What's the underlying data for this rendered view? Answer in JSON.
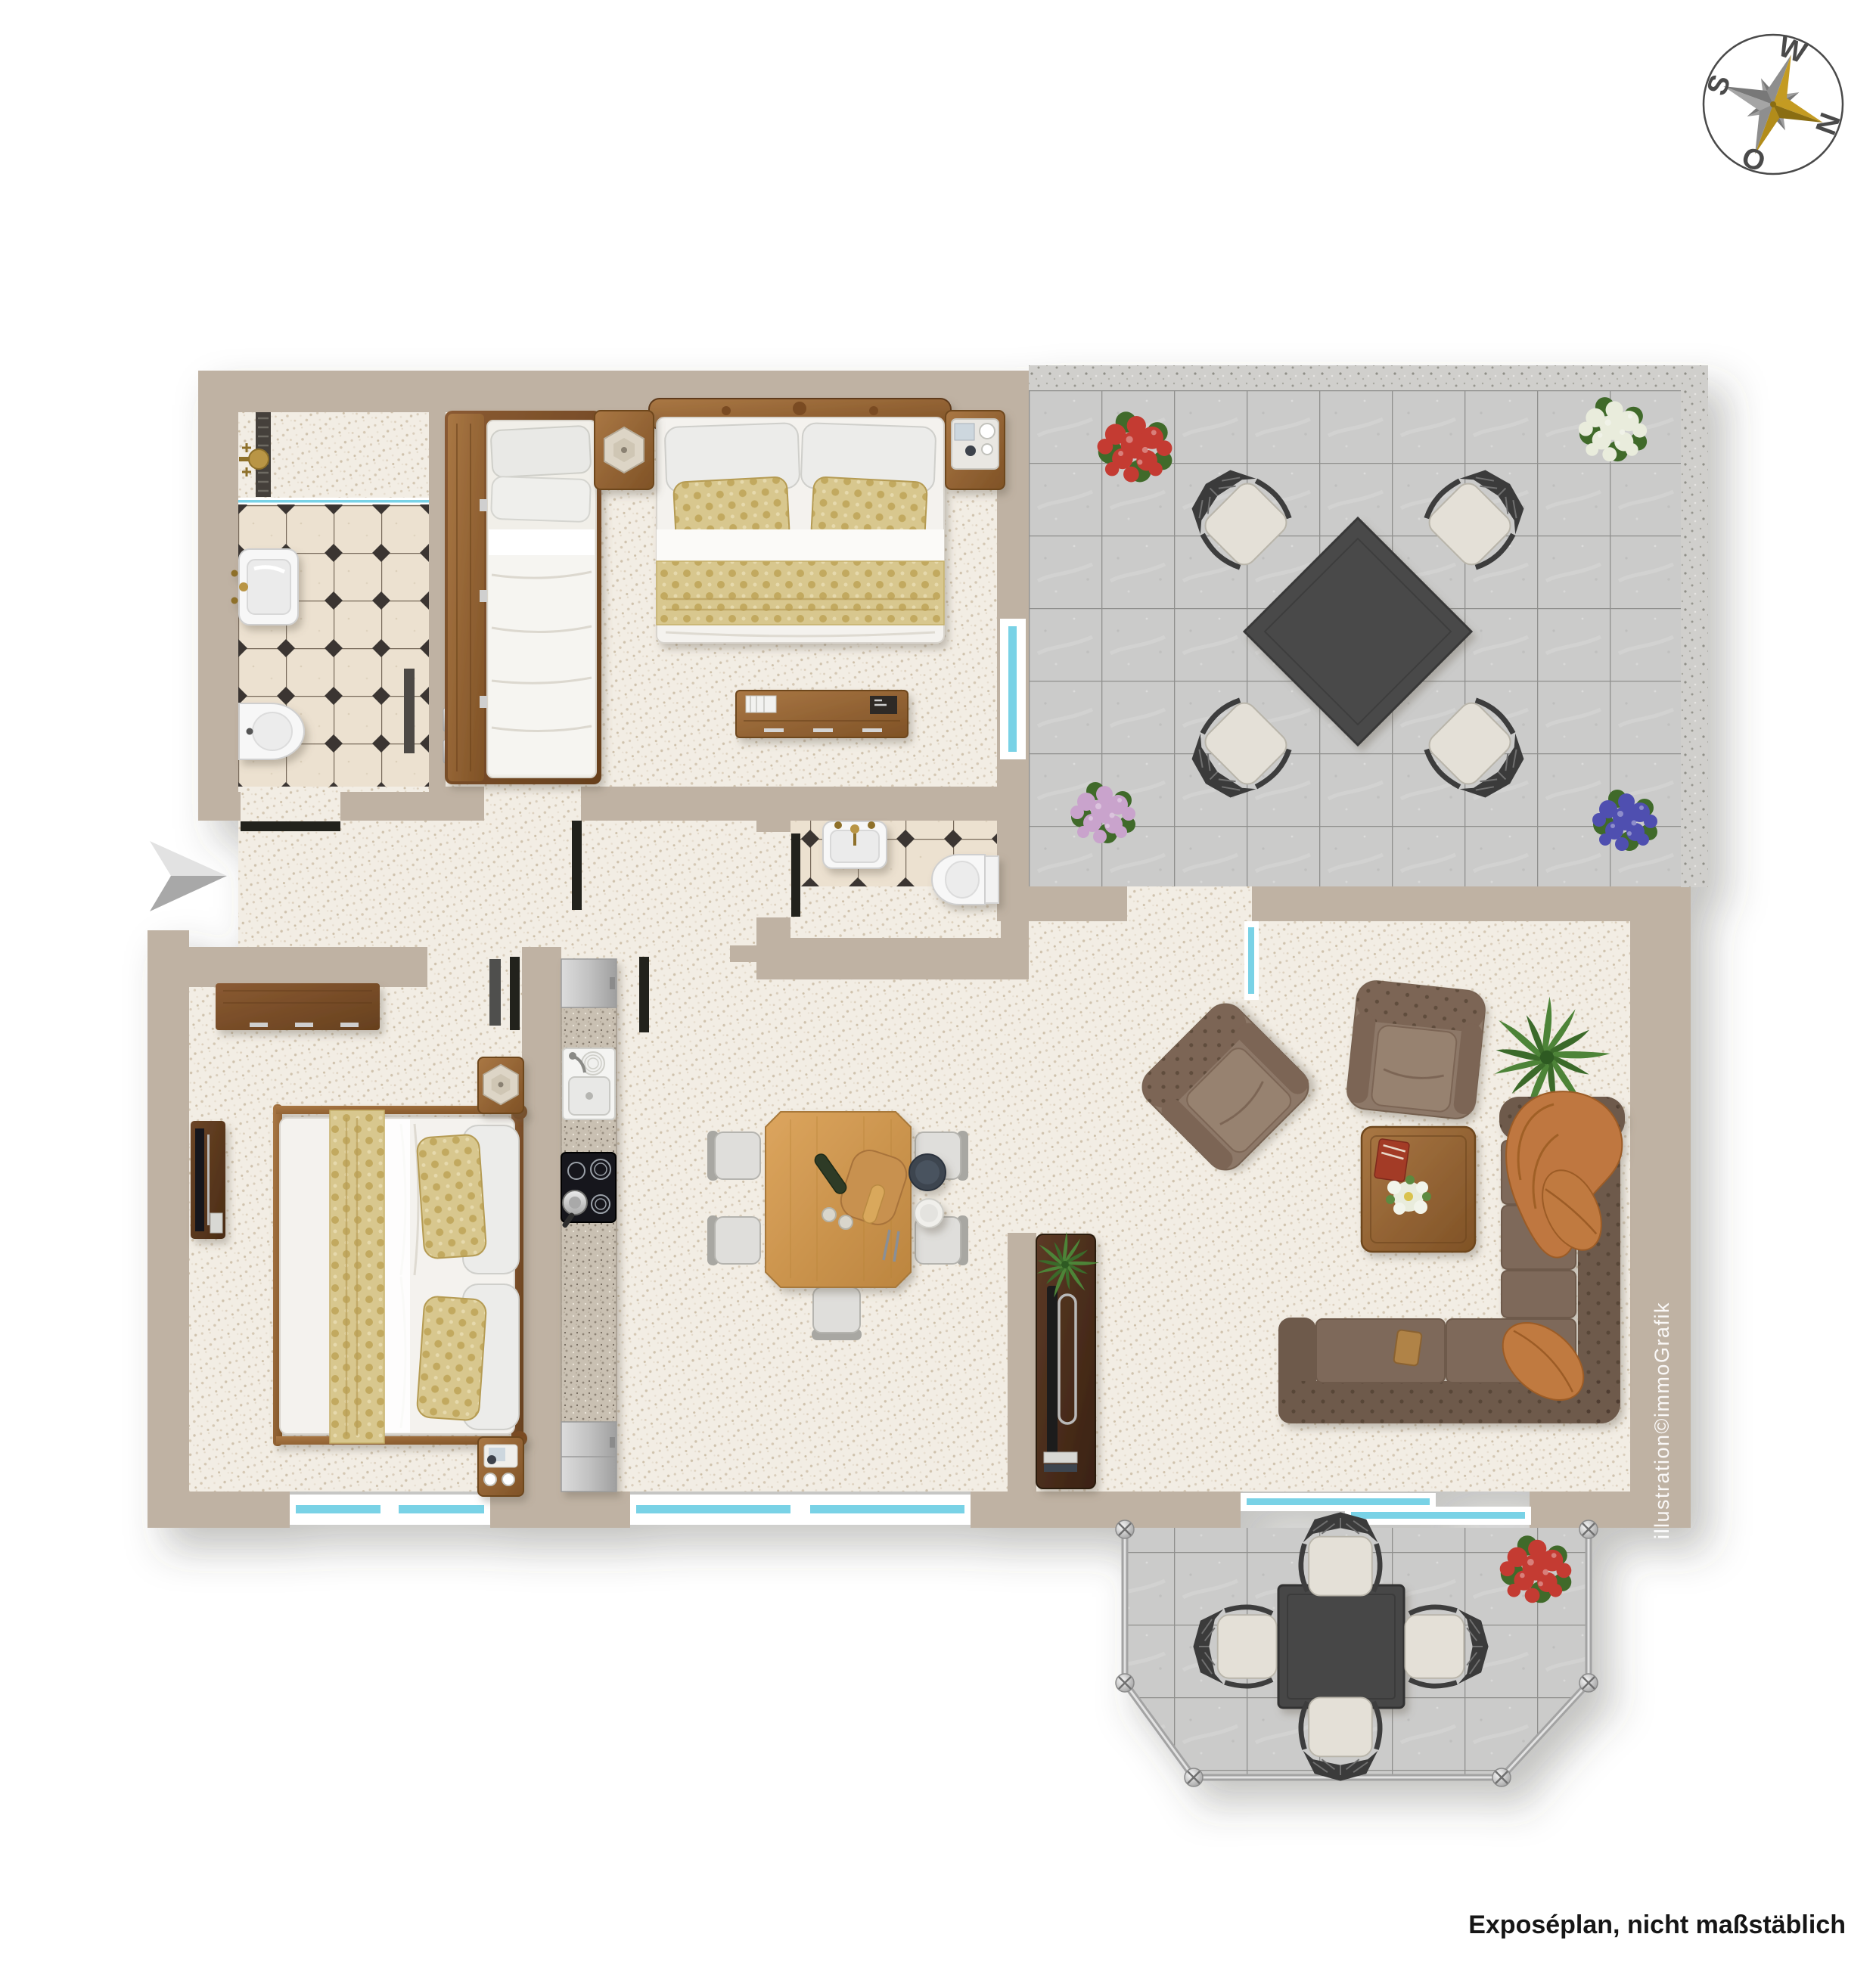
{
  "compass": {
    "letters": {
      "west": "W",
      "north": "N",
      "east": "O",
      "south": "S"
    },
    "icon": "compass-rose-icon",
    "gold": "#c49b22",
    "gray": "#8e8e8e",
    "ring": "#4a4a4a"
  },
  "watermark": {
    "text": "illustration©immoGrafik",
    "color": "#ffffff"
  },
  "footer": {
    "disclaimer": "Exposéplan, nicht maßstäblich",
    "color": "#161616"
  },
  "icons": {
    "compass": "compass-rose-icon",
    "entrance": "entrance-arrow-icon"
  },
  "palette": {
    "wall": "#bfb2a3",
    "glass": "#79d2e6",
    "floor": "#f2ede4",
    "bath_tile": "#ece1d0",
    "tile_diamond": "#3a3630",
    "terrace_tile": "#cbcbca",
    "concrete": "#d0cfcc",
    "granite": "#c9c0b2",
    "wood_dark": "#774a24",
    "wood_mid": "#96663a",
    "wood_honey": "#cf9a52",
    "sofa_dark": "#6e5a4c",
    "sofa_mid": "#7e695a",
    "armchair": "#8d7868",
    "accent_orange": "#c07a3f",
    "gold_fabric": "#d8c78e",
    "plant_green": "#4e8438",
    "text_mid": "#4a4a4a",
    "text_dark": "#161616"
  }
}
